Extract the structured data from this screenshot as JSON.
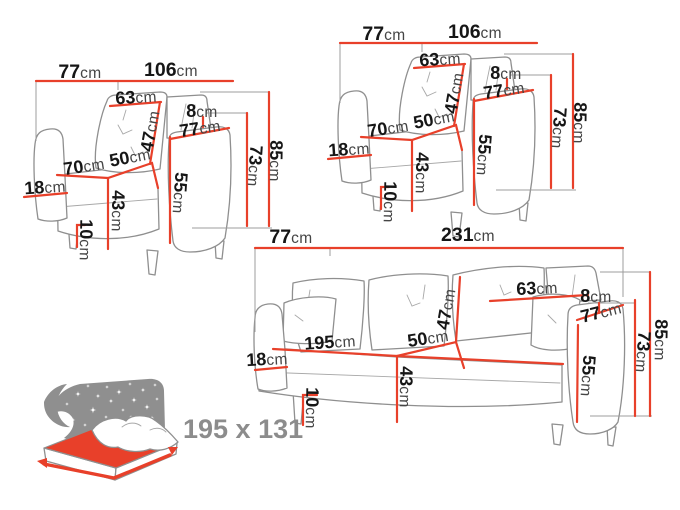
{
  "colors": {
    "accent_red": "#e8402a",
    "artwork_gray": "#8f8f8f",
    "helper_gray": "#9c9c9c",
    "label_black": "#161616",
    "unit_gray": "#454545",
    "bed_icon_gray": "#8f8f8f",
    "bed_text_gray": "#8c8c8c",
    "background": "#ffffff"
  },
  "figures": {
    "armchair": {
      "labels": {
        "overall_depth": {
          "num": "77",
          "unit": "cm"
        },
        "overall_width": {
          "num": "106",
          "unit": "cm"
        },
        "backrest_width": {
          "num": "63",
          "unit": "cm"
        },
        "backrest_height": {
          "num": "47",
          "unit": "cm"
        },
        "back_gap": {
          "num": "8",
          "unit": "cm"
        },
        "armrest_length": {
          "num": "77",
          "unit": "cm"
        },
        "seat_depth": {
          "num": "70",
          "unit": "cm"
        },
        "seat_width": {
          "num": "50",
          "unit": "cm"
        },
        "armrest_width": {
          "num": "18",
          "unit": "cm"
        },
        "seat_height": {
          "num": "43",
          "unit": "cm"
        },
        "leg_height": {
          "num": "10",
          "unit": "cm"
        },
        "armrest_height": {
          "num": "55",
          "unit": "cm"
        },
        "back_height": {
          "num": "73",
          "unit": "cm"
        },
        "total_height": {
          "num": "85",
          "unit": "cm"
        }
      }
    },
    "sofa": {
      "labels": {
        "overall_depth": {
          "num": "77",
          "unit": "cm"
        },
        "overall_width": {
          "num": "231",
          "unit": "cm"
        },
        "backrest_width": {
          "num": "63",
          "unit": "cm"
        },
        "backrest_height": {
          "num": "47",
          "unit": "cm"
        },
        "back_gap": {
          "num": "8",
          "unit": "cm"
        },
        "armrest_length": {
          "num": "77",
          "unit": "cm"
        },
        "seat_width": {
          "num": "195",
          "unit": "cm"
        },
        "seat_depth": {
          "num": "50",
          "unit": "cm"
        },
        "armrest_width": {
          "num": "18",
          "unit": "cm"
        },
        "seat_height": {
          "num": "43",
          "unit": "cm"
        },
        "leg_height": {
          "num": "10",
          "unit": "cm"
        },
        "armrest_height": {
          "num": "55",
          "unit": "cm"
        },
        "back_height": {
          "num": "73",
          "unit": "cm"
        },
        "total_height": {
          "num": "85",
          "unit": "cm"
        }
      }
    },
    "bed": {
      "size_label": "195 x 131"
    }
  }
}
